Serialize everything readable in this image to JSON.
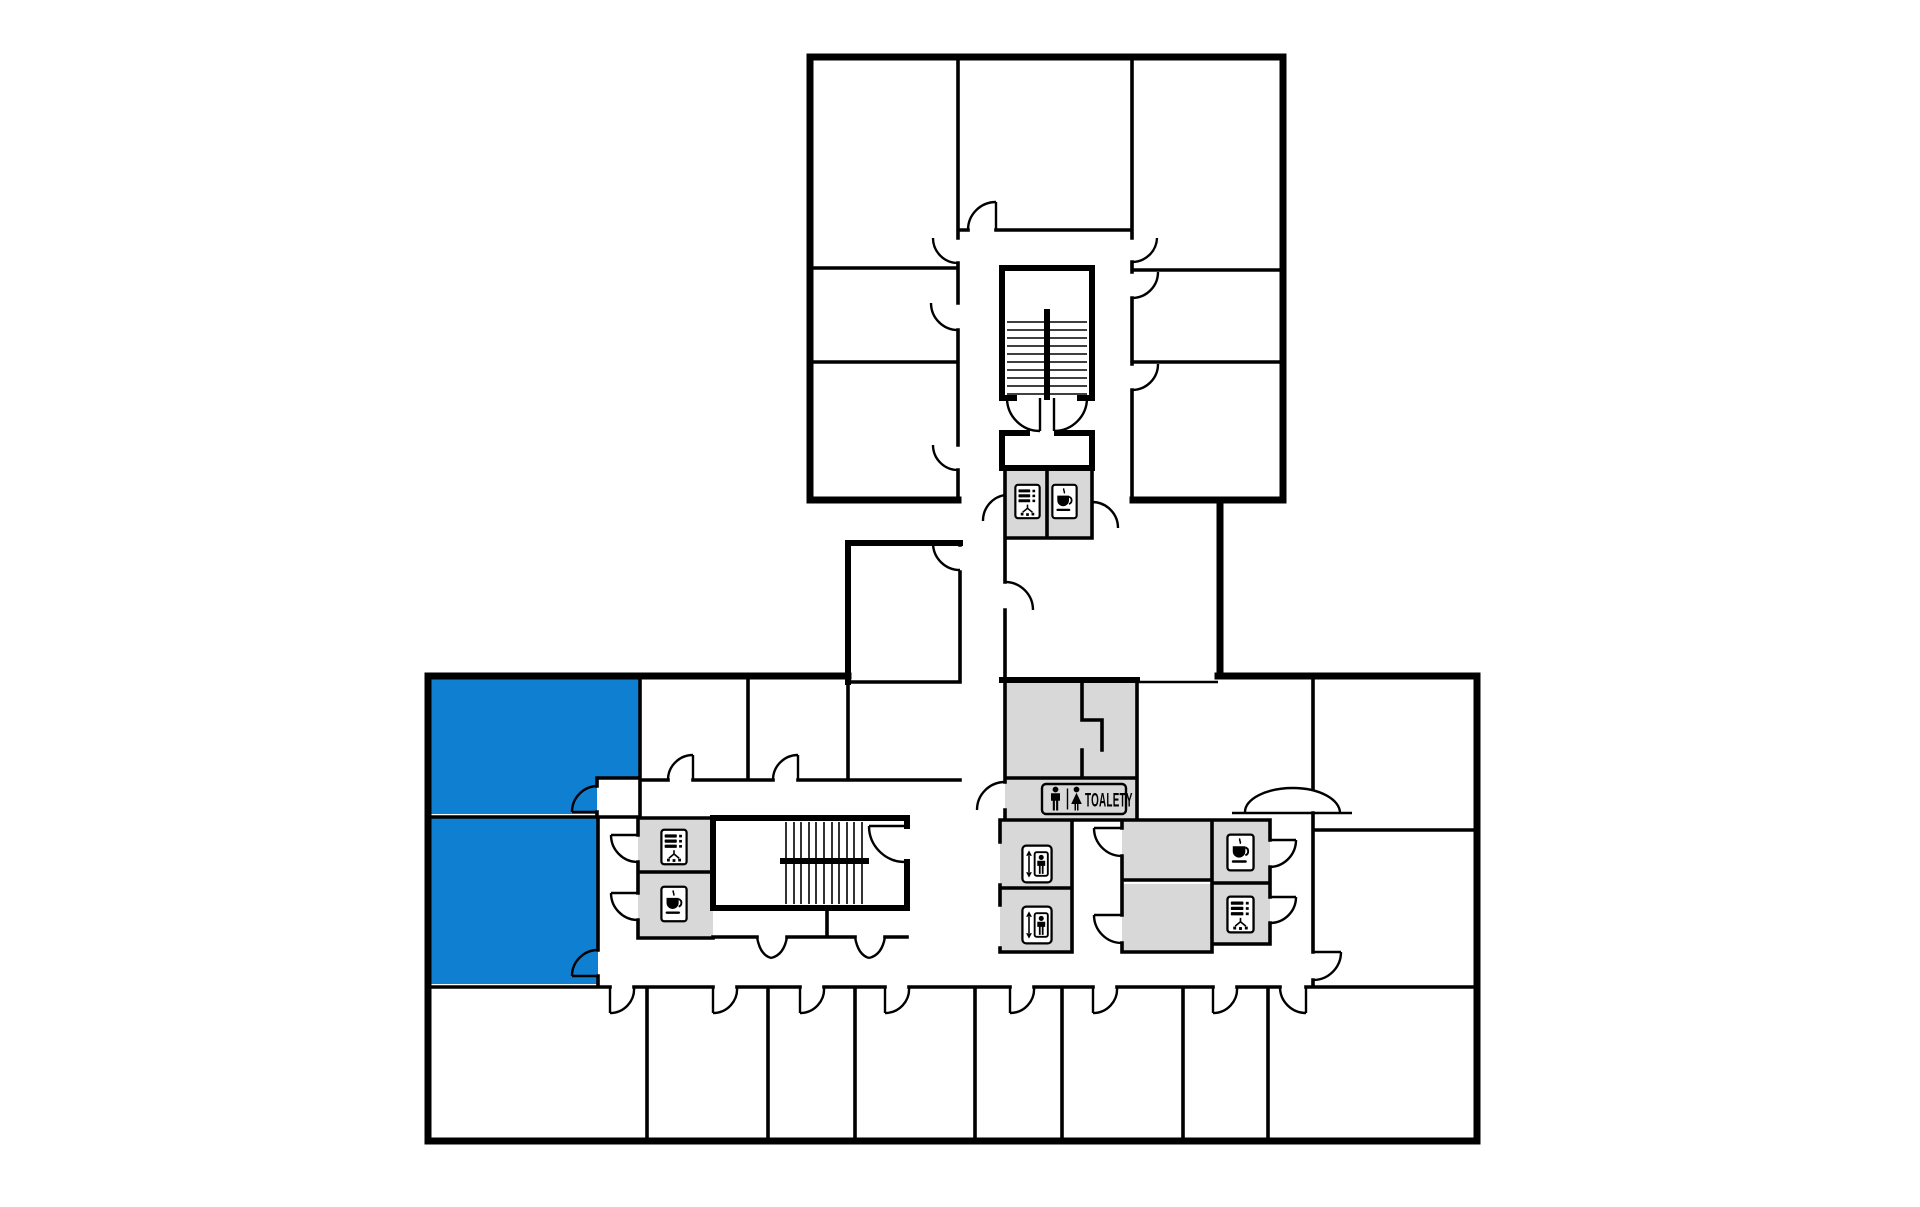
{
  "floorplan": {
    "labels": {
      "toilets": "TOALETY"
    },
    "colors": {
      "highlight_blue": "#0F7FD1",
      "service_gray": "#D8D8D8",
      "wall_black": "#000000",
      "background": "#FFFFFF"
    },
    "highlighted_rooms": [
      {
        "id": "unit-upper",
        "status": "highlighted"
      },
      {
        "id": "unit-lower",
        "status": "highlighted"
      }
    ],
    "icons": [
      {
        "name": "vending-machine-icon",
        "location": "upper-wing-service"
      },
      {
        "name": "coffee-icon",
        "location": "upper-wing-service"
      },
      {
        "name": "vending-machine-icon",
        "location": "stairwell-west-service"
      },
      {
        "name": "coffee-icon",
        "location": "stairwell-west-service"
      },
      {
        "name": "elevator-icon",
        "location": "elevator-shaft-1"
      },
      {
        "name": "elevator-icon",
        "location": "elevator-shaft-2"
      },
      {
        "name": "coffee-icon",
        "location": "east-service"
      },
      {
        "name": "vending-machine-icon",
        "location": "east-service"
      },
      {
        "name": "mens-restroom-icon",
        "location": "toilets-sign"
      },
      {
        "name": "womens-restroom-icon",
        "location": "toilets-sign"
      }
    ]
  }
}
